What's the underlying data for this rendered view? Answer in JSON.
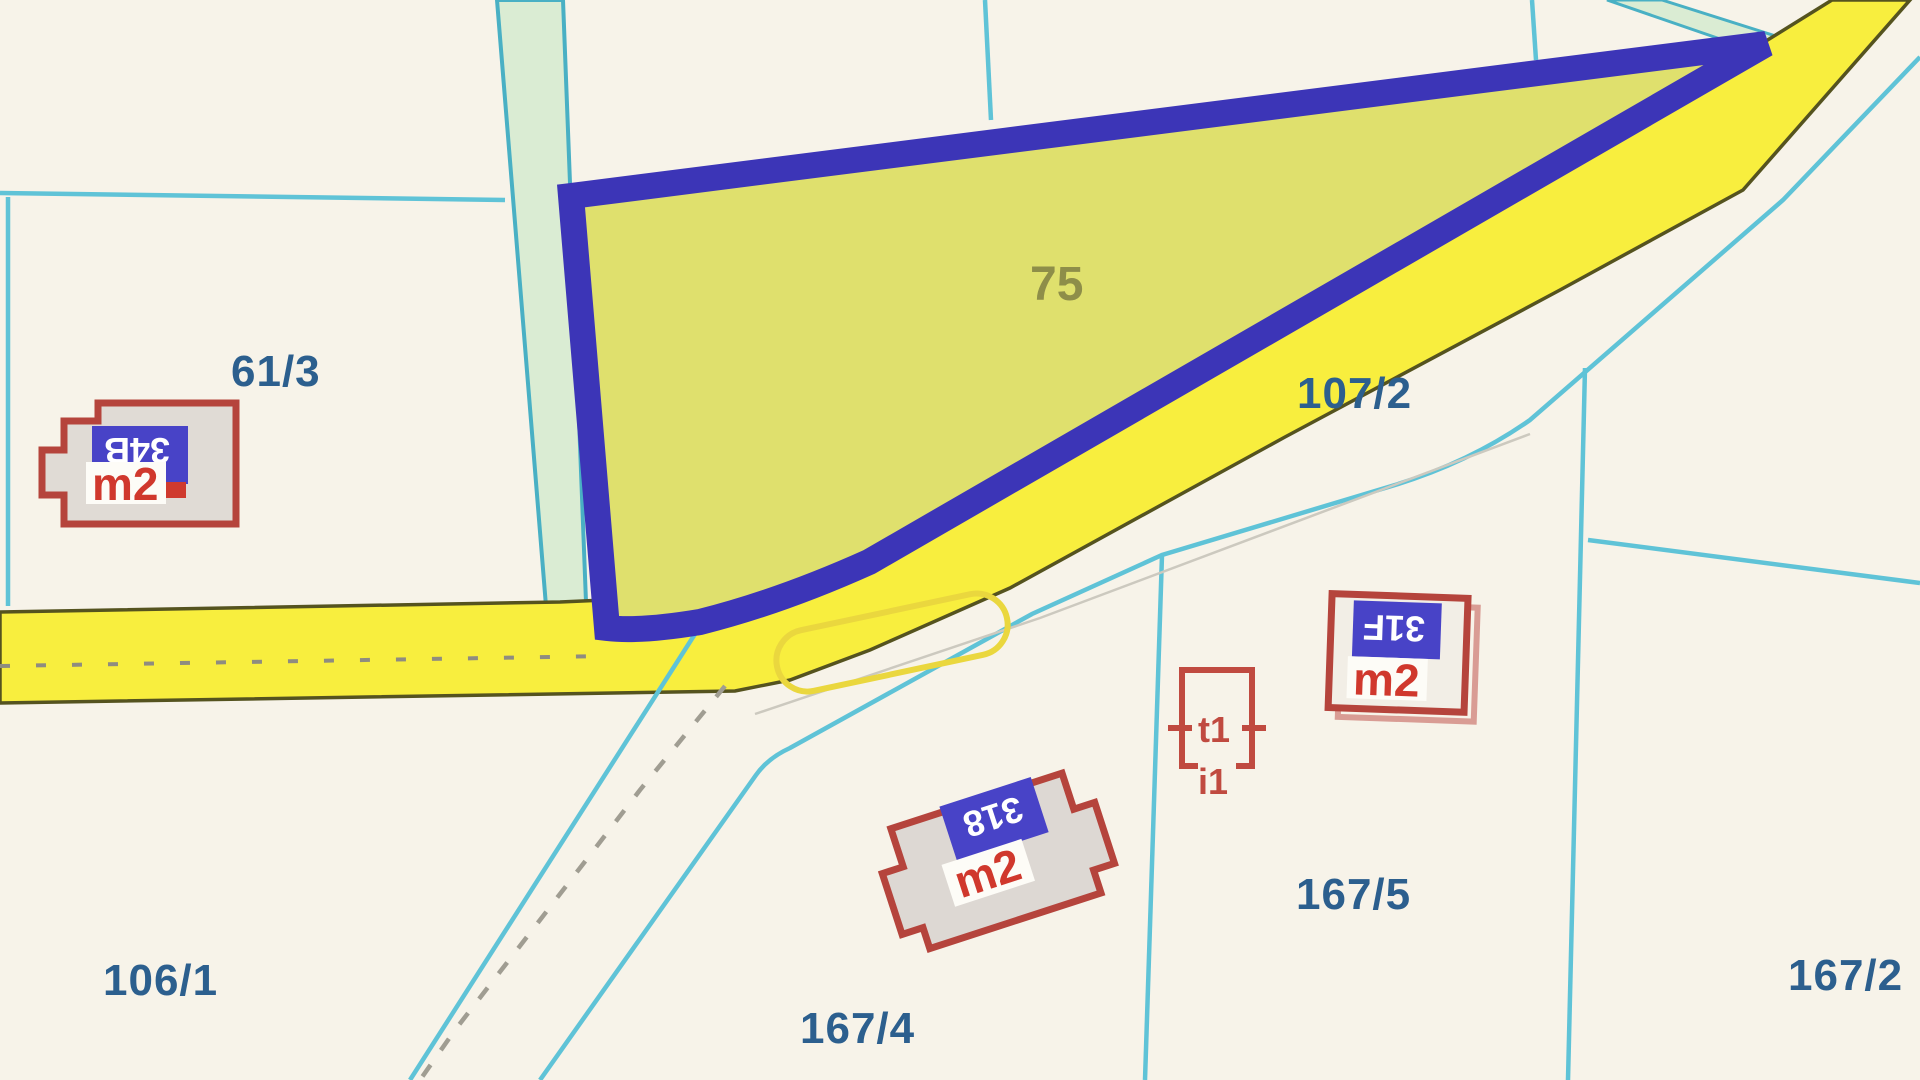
{
  "map_type": "cadastral-parcel-map",
  "selected_parcel": {
    "number": "75"
  },
  "parcels": [
    {
      "number": "61/3"
    },
    {
      "number": "107/2"
    },
    {
      "number": "106/1"
    },
    {
      "number": "167/4"
    },
    {
      "number": "167/5"
    },
    {
      "number": "167/2"
    }
  ],
  "buildings": [
    {
      "badge": "34B",
      "unit": "m2"
    },
    {
      "badge": "31F",
      "unit": "m2"
    },
    {
      "badge": "318",
      "unit": "m2"
    },
    {
      "marks": [
        "t1",
        "i1"
      ]
    }
  ],
  "colors": {
    "background": "#f7f3e9",
    "selected_parcel_fill": "#dfe06d",
    "selected_parcel_border": "#3c35b7",
    "road_fill": "#f8ee3e",
    "road_edge": "#55531f",
    "boundary_line": "#5fc3d7",
    "green_strip": "#daecd3",
    "building_outline": "#b5443c",
    "building_fill": "#e0dbd5",
    "badge_blue": "#4843c7",
    "m2_red": "#d0382d",
    "parcel_label_blue": "#2c5f8e",
    "selected_label_olive": "#8e8e49",
    "dashed_track_gray": "#a09d92"
  }
}
